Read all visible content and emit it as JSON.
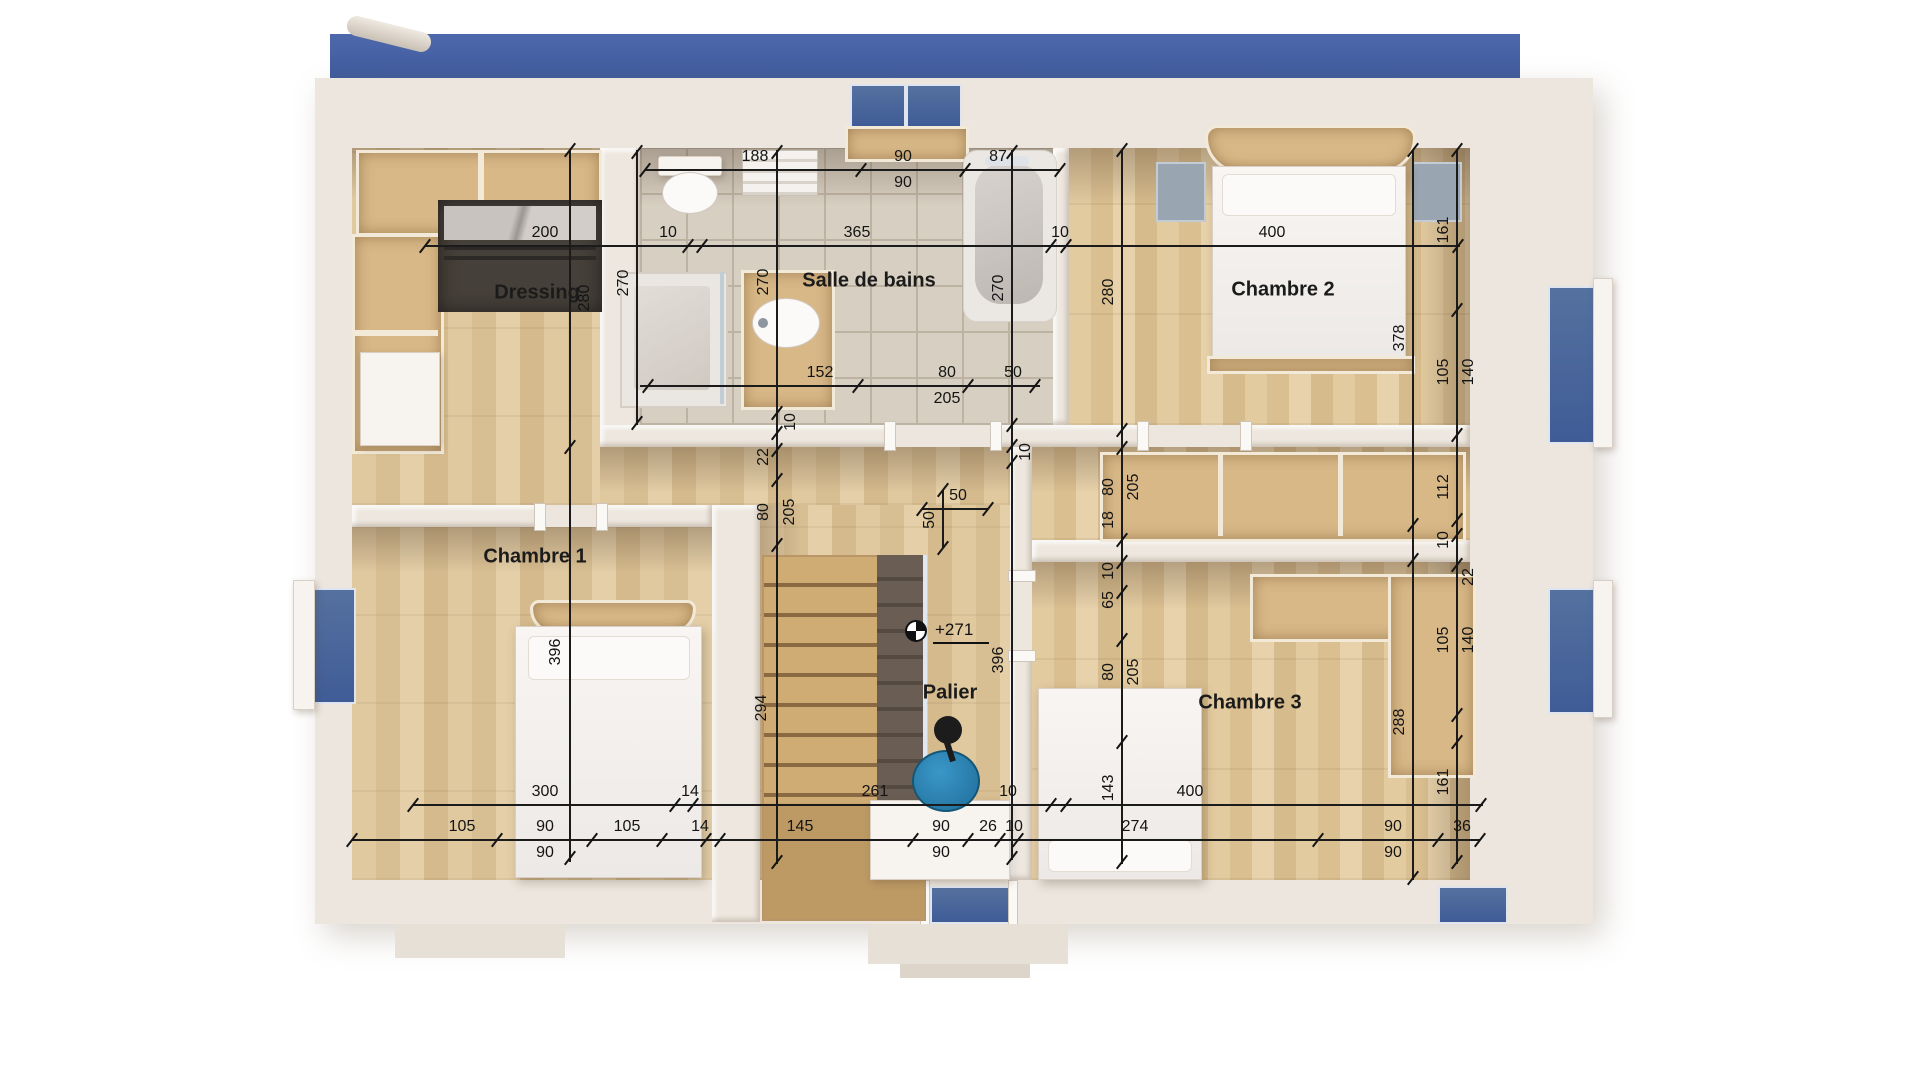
{
  "rooms": {
    "dressing": "Dressing",
    "bathroom": "Salle de bains",
    "bedroom1": "Chambre 1",
    "bedroom2": "Chambre 2",
    "bedroom3": "Chambre 3",
    "landing": "Palier"
  },
  "level_marker": {
    "value": "+271"
  },
  "dims": {
    "top_fixture": [
      "188",
      "90",
      "90",
      "87"
    ],
    "top_main": [
      "200",
      "10",
      "365",
      "10",
      "400"
    ],
    "bath_bottom": [
      "152",
      "80",
      "205",
      "50"
    ],
    "left_vert": [
      "280",
      "396"
    ],
    "toilet_vert": [
      "270"
    ],
    "center_vert": [
      "270",
      "10",
      "22",
      "80",
      "205",
      "294"
    ],
    "landing_vert": [
      "270",
      "10",
      "396"
    ],
    "mid_right_vert": [
      "280",
      "80",
      "205",
      "18",
      "10",
      "65",
      "80",
      "205",
      "143"
    ],
    "inner_right_vert": [
      "378",
      "288"
    ],
    "right_vert": [
      "161",
      "105",
      "140",
      "112",
      "10",
      "22",
      "105",
      "140",
      "161"
    ],
    "cross": [
      "50",
      "50"
    ],
    "bottom_row1": [
      "300",
      "14",
      "261",
      "10",
      "400"
    ],
    "bottom_row2": [
      "105",
      "90",
      "90",
      "105",
      "14",
      "145",
      "90",
      "90",
      "26",
      "10",
      "274",
      "90",
      "90",
      "36"
    ]
  },
  "colors": {
    "wood": "#ddc69e",
    "tile": "#d7cfc1",
    "wall": "#ede7df",
    "window_glass": "#3f5c97",
    "dim_ink": "#1b1b1b",
    "chair_accent": "#2a7fae"
  }
}
